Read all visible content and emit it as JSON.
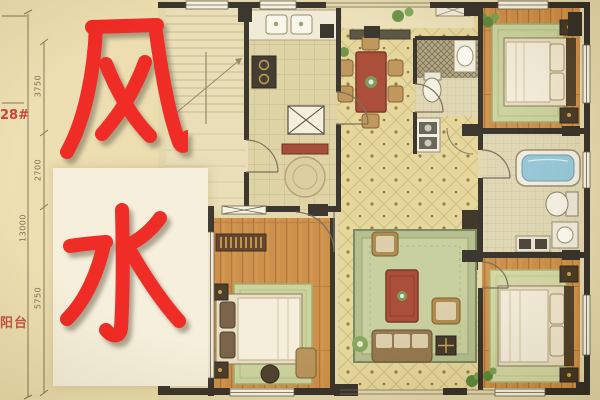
{
  "overlay": {
    "character_top": "风",
    "character_bottom": "水",
    "building_number": "28#",
    "balcony_label": "阳台"
  },
  "dimensions": {
    "seg_top": "3750",
    "seg_mid": "2700",
    "seg_bottom": "5750",
    "total_height": "13000"
  },
  "colors": {
    "overlay_red": "#ee1510",
    "background_beige": "#e8d9a6",
    "plan_paper": "#e1d5a7",
    "wall_black": "#26211a",
    "wood_floor": "#cd8b40",
    "tile_yellow": "#e3d395",
    "furniture_red": "#a23a26",
    "bathtub_blue": "#8cc2d6",
    "rug_green": "#c6cf97",
    "panel_white": "#f4eeda"
  }
}
